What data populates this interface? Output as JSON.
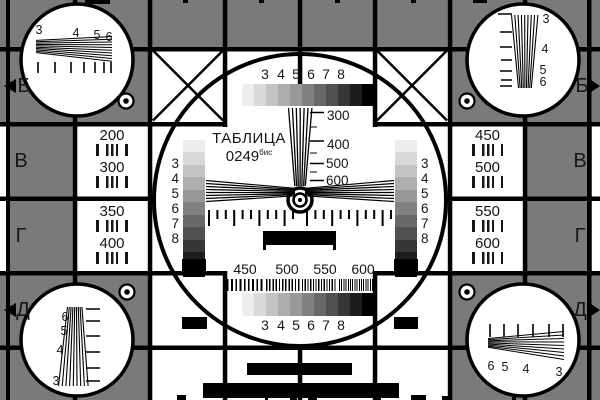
{
  "colors": {
    "bg": "#7a7a7a",
    "line": "#000000",
    "white": "#ffffff",
    "text": "#161616"
  },
  "grayscale_steps": [
    "#ededed",
    "#d9d9d9",
    "#c4c4c4",
    "#aeaeae",
    "#989898",
    "#818181",
    "#686868",
    "#505050",
    "#373737",
    "#1d1d1d",
    "#000000"
  ],
  "title": {
    "name": "ТАБЛИЦА",
    "code": "0249",
    "code_sup": "бис"
  },
  "rows": {
    "left": [
      "Б",
      "В",
      "Г",
      "Д"
    ],
    "right": [
      "Б",
      "В",
      "Г",
      "Д"
    ]
  },
  "freq_cells": {
    "left_top": [
      "200",
      "300"
    ],
    "left_bottom": [
      "350",
      "400"
    ],
    "right_top": [
      "450",
      "500"
    ],
    "right_bottom": [
      "550",
      "600"
    ]
  },
  "center": {
    "top_scale": [
      "3",
      "4",
      "5",
      "6",
      "7",
      "8"
    ],
    "bottom_scale": [
      "3",
      "4",
      "5",
      "6",
      "7",
      "8"
    ],
    "left_scale": [
      "3",
      "4",
      "5",
      "6",
      "7",
      "8"
    ],
    "right_scale": [
      "3",
      "4",
      "5",
      "6",
      "7",
      "8"
    ],
    "vwedge": [
      "300",
      "400",
      "500",
      "600"
    ],
    "burst": [
      "450",
      "500",
      "550",
      "600"
    ]
  },
  "corners": {
    "top_left": [
      "3",
      "4",
      "5",
      "6"
    ],
    "top_right": [
      "3",
      "4",
      "5",
      "6"
    ],
    "bottom_left": [
      "6",
      "5",
      "4",
      "3"
    ],
    "bottom_right": [
      "6",
      "5",
      "4",
      "3"
    ]
  }
}
